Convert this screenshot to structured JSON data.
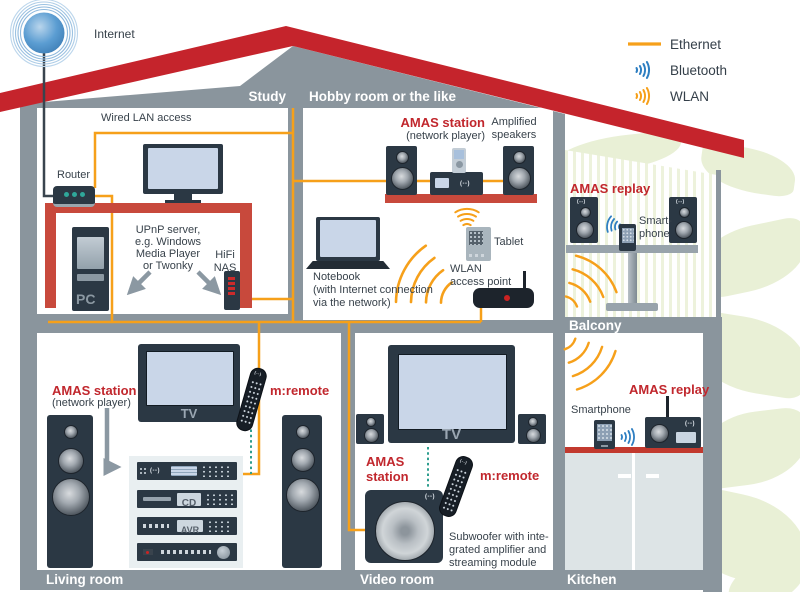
{
  "colors": {
    "roof_red": "#c5242c",
    "wall_gray": "#8a959d",
    "accent_text_red": "#c1272d",
    "ethernet_orange": "#f6a01a",
    "bluetooth_blue": "#2e7fc2",
    "wlan_orange": "#f6a01a",
    "remote_link_teal": "#2f9e8f",
    "device_dark": "#2b3844",
    "furniture_red": "#c8493c",
    "screen_blue": "#c9d6e8",
    "leaf_green": "#e9f0d6"
  },
  "internet": {
    "label": "Internet"
  },
  "legend": {
    "ethernet": "Ethernet",
    "bluetooth": "Bluetooth",
    "wlan": "WLAN"
  },
  "brand_mark": "(--)",
  "study": {
    "label": "Study",
    "wired_lan": "Wired LAN access",
    "router": "Router",
    "upnp": "UPnP server,\ne.g. Windows\nMedia Player\nor Twonky",
    "nas": "HiFi\nNAS",
    "pc": "PC"
  },
  "hobby": {
    "label": "Hobby room or the like",
    "station_title": "AMAS station",
    "station_sub": "(network player)",
    "speakers": "Amplified\nspeakers",
    "notebook": "Notebook\n(with Internet connection\nvia the network)",
    "tablet": "Tablet",
    "access_point": "WLAN\naccess point"
  },
  "balcony": {
    "label": "Balcony",
    "replay": "AMAS replay",
    "smartphone": "Smart-\nphone"
  },
  "living": {
    "label": "Living room",
    "station_title": "AMAS station",
    "station_sub": "(network player)",
    "tv": "TV",
    "remote": "m:remote",
    "cd": "CD",
    "avr": "AVR"
  },
  "video": {
    "label": "Video room",
    "tv": "TV",
    "station_title": "AMAS\nstation",
    "remote": "m:remote",
    "subwoofer": "Subwoofer with inte-\ngrated amplifier and\nstreaming module"
  },
  "kitchen": {
    "label": "Kitchen",
    "replay": "AMAS replay",
    "smartphone": "Smartphone"
  }
}
